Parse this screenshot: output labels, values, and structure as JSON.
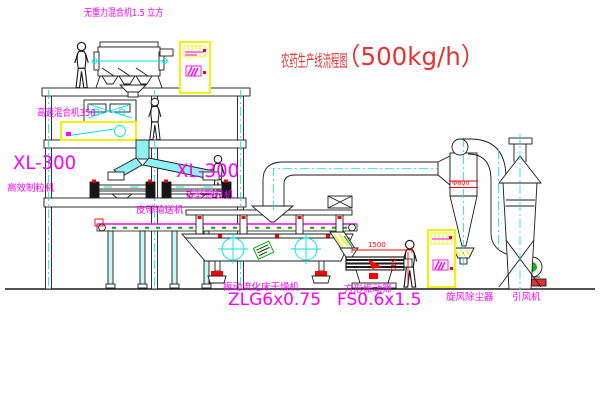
{
  "title": {
    "name_cn": "农药生产线流程图",
    "capacity": "（500kg/h）"
  },
  "labels": {
    "gravity_mixer": "无重力混合机1.5 立方",
    "high_speed_mixer": "高速混合机350",
    "granulator_left_model": "XL-300",
    "granulator_left_name": "高效制粒机",
    "granulator_right_model": "XL-300",
    "granulator_right_name": "旋转制粒机",
    "belt_conveyor": "皮带输送机",
    "fluid_bed_dryer_name": "振动流化床干燥机",
    "fluid_bed_dryer_model": "ZLG6x0.75",
    "square_sieve_name": "方形振动筛",
    "square_sieve_model": "FS0.6x1.5",
    "cyclone": "旋风除尘器",
    "fan": "引风机"
  },
  "dimensions": {
    "cyclone_diameter": "Φ800",
    "sieve_length": "1500",
    "sieve_height": "540"
  },
  "colors": {
    "label_magenta": "#ff00ff",
    "title_red": "#e33434",
    "dimension_red": "#ff0000",
    "centerline_cyan": "#00e5e5",
    "cabinet_yellow": "#f2f20a",
    "accent_green": "#18a818",
    "line_black": "#1b1b1b",
    "background": "#ffffff"
  }
}
